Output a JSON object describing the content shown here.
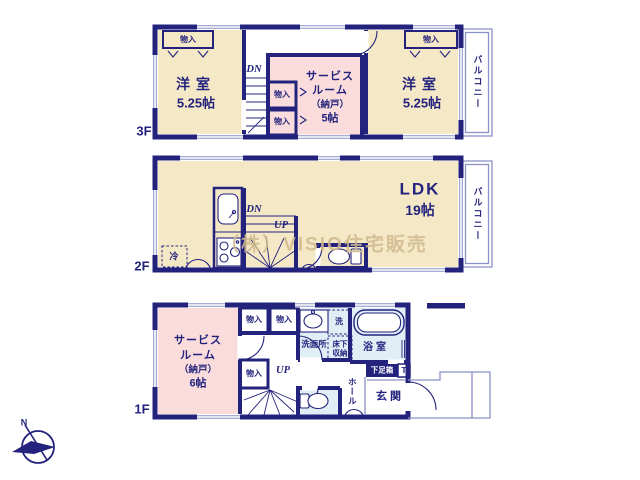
{
  "colors": {
    "wall": "#23237d",
    "room_cream": "#f5e8c6",
    "room_pink": "#fadcdc",
    "room_wet": "#e0eef6",
    "watermark": "#d0ba8e"
  },
  "watermark_text": "（株）VISIO住宅販売",
  "compass": {
    "north_label": "N"
  },
  "floor3": {
    "floor_label": "3F",
    "balcony_label": "バルコニー",
    "room_west_left": {
      "name": "洋室",
      "area": "5.25帖"
    },
    "room_west_right": {
      "name": "洋室",
      "area": "5.25帖"
    },
    "service_room": {
      "name_line1": "サービス",
      "name_line2": "ルーム",
      "name_line3": "（納戸）",
      "area": "5帖"
    },
    "closet_left": "物入",
    "closet_right": "物入",
    "closet_mid_top": "物入",
    "closet_mid_bottom": "物入",
    "stairs_down_label": "DN"
  },
  "floor2": {
    "floor_label": "2F",
    "balcony_label": "バルコニー",
    "ldk": {
      "name": "LDK",
      "area": "19帖"
    },
    "stairs_down_label": "DN",
    "stairs_up_label": "UP",
    "refrigerator_label": "冷"
  },
  "floor1": {
    "floor_label": "1F",
    "service_room": {
      "name_line1": "サービス",
      "name_line2": "ルーム",
      "name_line3": "（納戸）",
      "area": "6帖"
    },
    "closet_top_left": "物入",
    "closet_top_right": "物入",
    "closet_middle": "物入",
    "stairs_up_label": "UP",
    "washroom_label": "洗面所",
    "laundry_label": "洗",
    "underfloor_storage_line1": "床下",
    "underfloor_storage_line2": "収納",
    "bathroom_label": "浴室",
    "shoe_cabinet_label": "下足箱",
    "t_box_label": "T",
    "hall_label": "ホール",
    "entrance_label": "玄関"
  }
}
